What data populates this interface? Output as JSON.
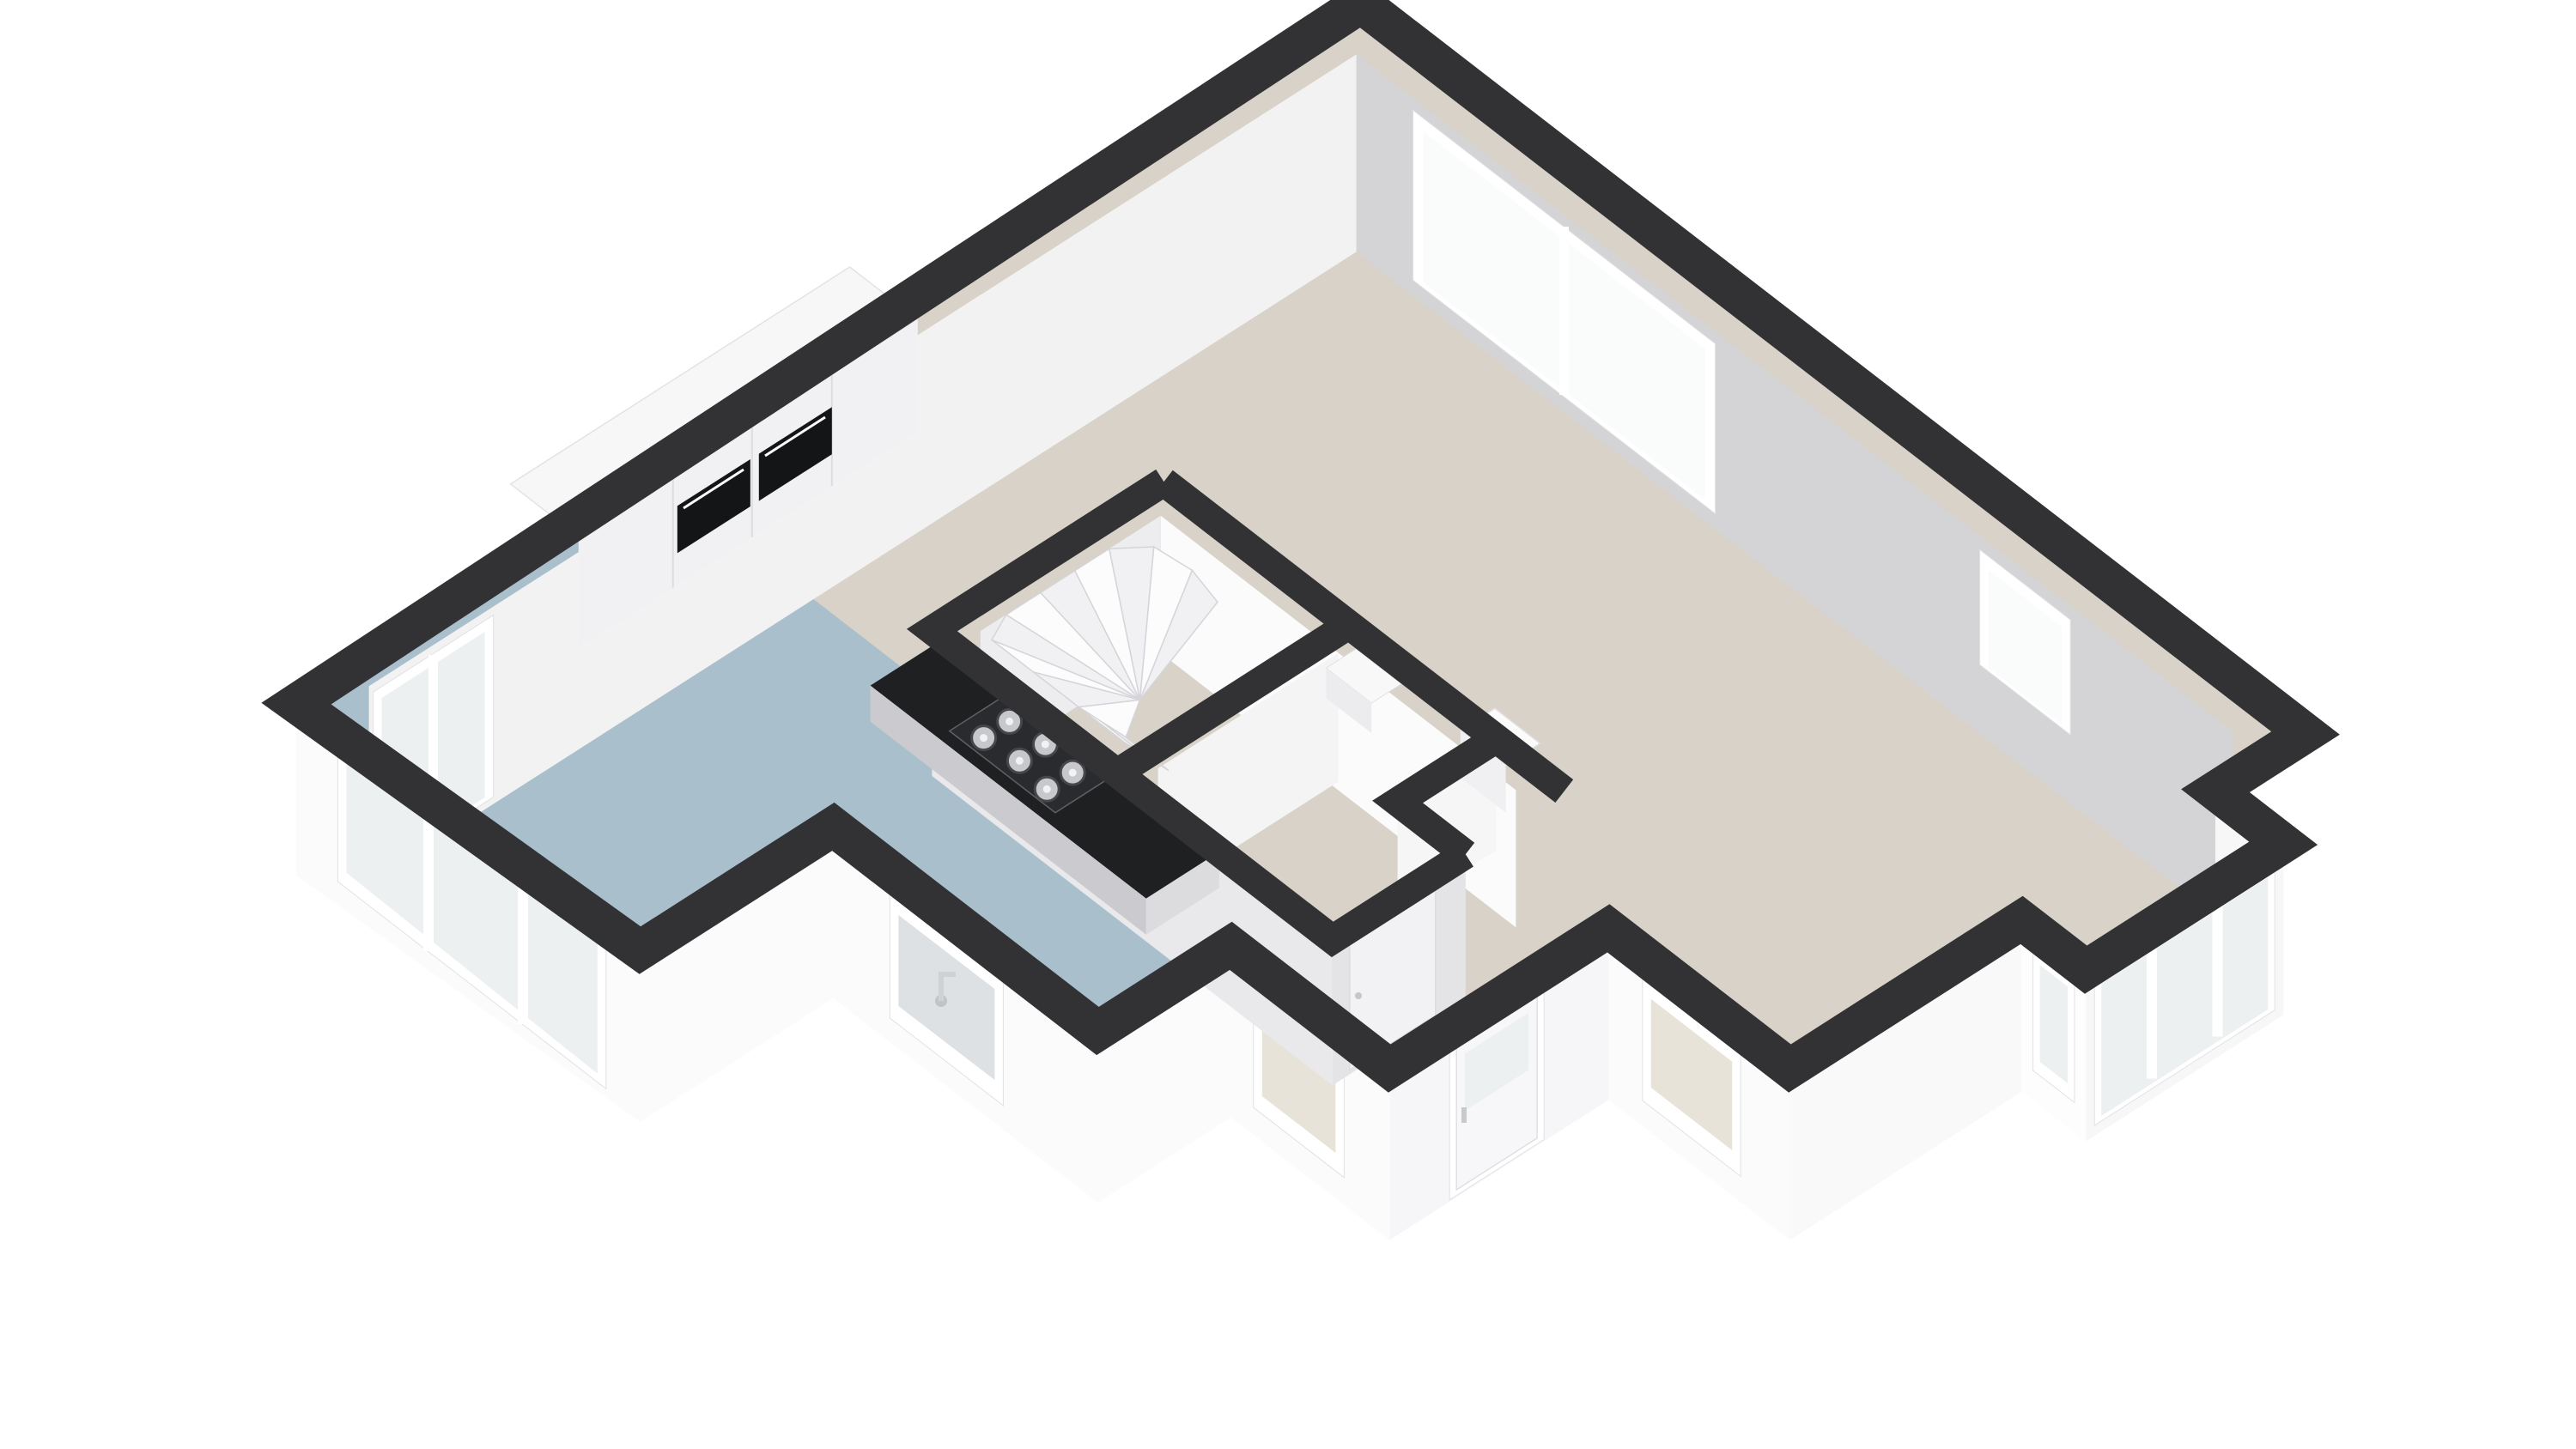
{
  "view": {
    "kind": "isometric-3d-floor-plan-render",
    "background": "#ffffff"
  },
  "colors": {
    "background": "#ffffff",
    "wall_cap": "#323235",
    "floor_living": "#d8d2c8",
    "floor_kitchen": "#a9bfcc",
    "wall_interior_gray": "#d4d4d6",
    "wall_interior_white": "#f2f2f3",
    "wall_exterior_white": "#fbfbfc",
    "wall_exterior_shade": "#f7f7f8",
    "core_wall_shade": "#e4e4e7",
    "window_frame": "#ffffff",
    "glass_bright": "#fafbfb",
    "glass_cool": "#ecf0f1",
    "glass_pale_blue": "#dde1e3",
    "glass_tinted_interior": "#e8e3d9",
    "counter_top": "#1f2022",
    "counter_front": "#cbcbcf",
    "cooktop_panel": "#2a2b2e",
    "burner_steel": "#c7c8cb",
    "cabinet_top": "#f7f7f8",
    "cabinet_front": "#f1f1f3",
    "oven_black": "#141517",
    "stair_tread_light": "#fcfcfd",
    "stair_tread_shade": "#f1f1f4",
    "boiler_body": "#fbfbfc",
    "boiler_accent_red": "#a6523f",
    "door_panel": "#f7f7f9"
  },
  "scene": {
    "rooms": [
      {
        "name": "living-room",
        "floor": "beige"
      },
      {
        "name": "kitchen",
        "floor": "blue-gray"
      },
      {
        "name": "hallway",
        "floor": "beige"
      },
      {
        "name": "stairwell",
        "feature": "winder-staircase"
      },
      {
        "name": "toilet",
        "feature": "door"
      },
      {
        "name": "tech-niche",
        "feature": "boiler-unit"
      }
    ],
    "features": [
      "double-sliding-window-north-east",
      "small-window-north-east",
      "bay-window-band-east",
      "bay-end-window",
      "living-window-south-east",
      "front-door-with-glass-pane",
      "hall-window",
      "kitchen-sink-window",
      "sliding-glass-doors-south-west",
      "tall-window-west-corner",
      "tall-cabinets-with-double-oven",
      "island-counter-with-gas-hob-6-burners",
      "winder-staircase",
      "boiler-unit-in-niche"
    ]
  }
}
